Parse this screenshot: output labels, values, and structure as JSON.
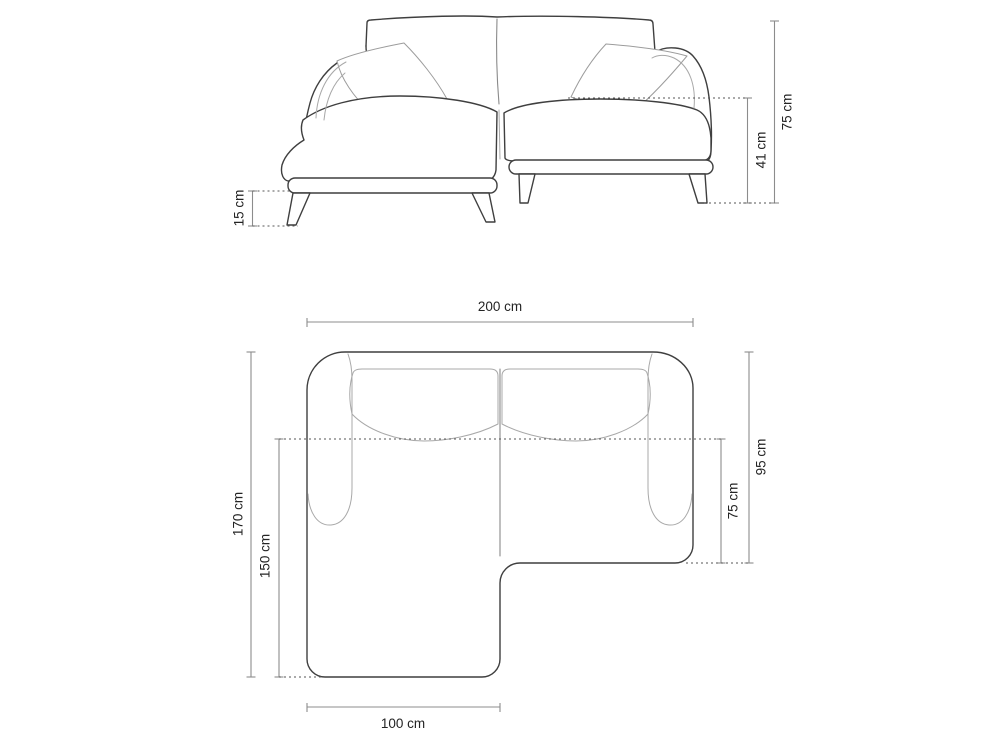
{
  "diagram": {
    "title": "corner-sofa-dimension-drawing",
    "views": {
      "front": {
        "name": "front-elevation",
        "dimensions": {
          "total_height": "75 cm",
          "seat_height": "41 cm",
          "leg_height": "15 cm"
        }
      },
      "top": {
        "name": "top-plan",
        "dimensions": {
          "total_width": "200 cm",
          "total_depth": "170 cm",
          "chaise_depth": "150 cm",
          "right_depth": "95 cm",
          "right_seat_depth": "75 cm",
          "chaise_width": "100 cm"
        }
      }
    },
    "colors": {
      "background": "#ffffff",
      "outline": "#3f3f3f",
      "interior_line": "#a8a8a8",
      "dimension_line": "#8c8c8c",
      "dotted_line": "#565656",
      "label_text": "#242424"
    }
  }
}
